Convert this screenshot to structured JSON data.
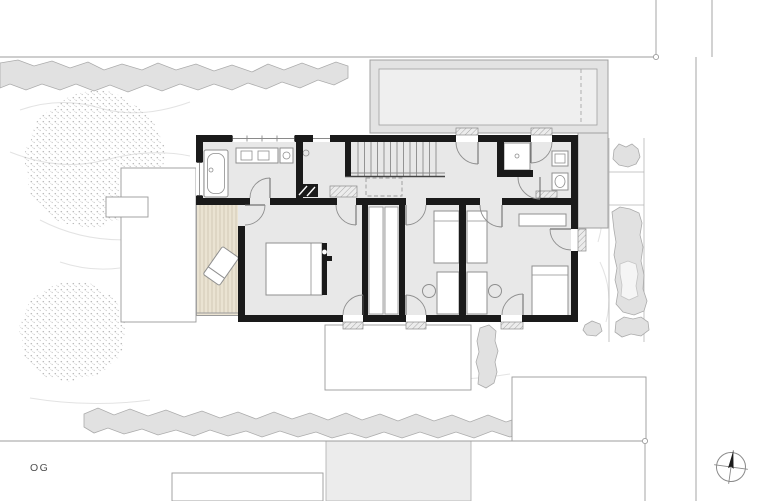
{
  "plan": {
    "label": "OG",
    "type": "architectural-floor-plan-upper-floor"
  },
  "compass": {
    "icon": "north-arrow-icon"
  },
  "colors": {
    "wall": "#1a1a1a",
    "floor": "#e8e8e8",
    "deck": "#eae3d2",
    "deck_line": "#ccc4ae",
    "roof": "#e3e3e3",
    "roof_inner": "#efefef",
    "hedge": "#e1e1e1",
    "hedge_edge": "#ababab",
    "site_line": "#9c9c9c",
    "outline": "#9a9a9a",
    "furniture": "#ffffff",
    "furniture_edge": "#8f8f8f",
    "swing": "#8f8f8f",
    "needle": "#1c1c1c",
    "text": "#4f4f4f"
  }
}
